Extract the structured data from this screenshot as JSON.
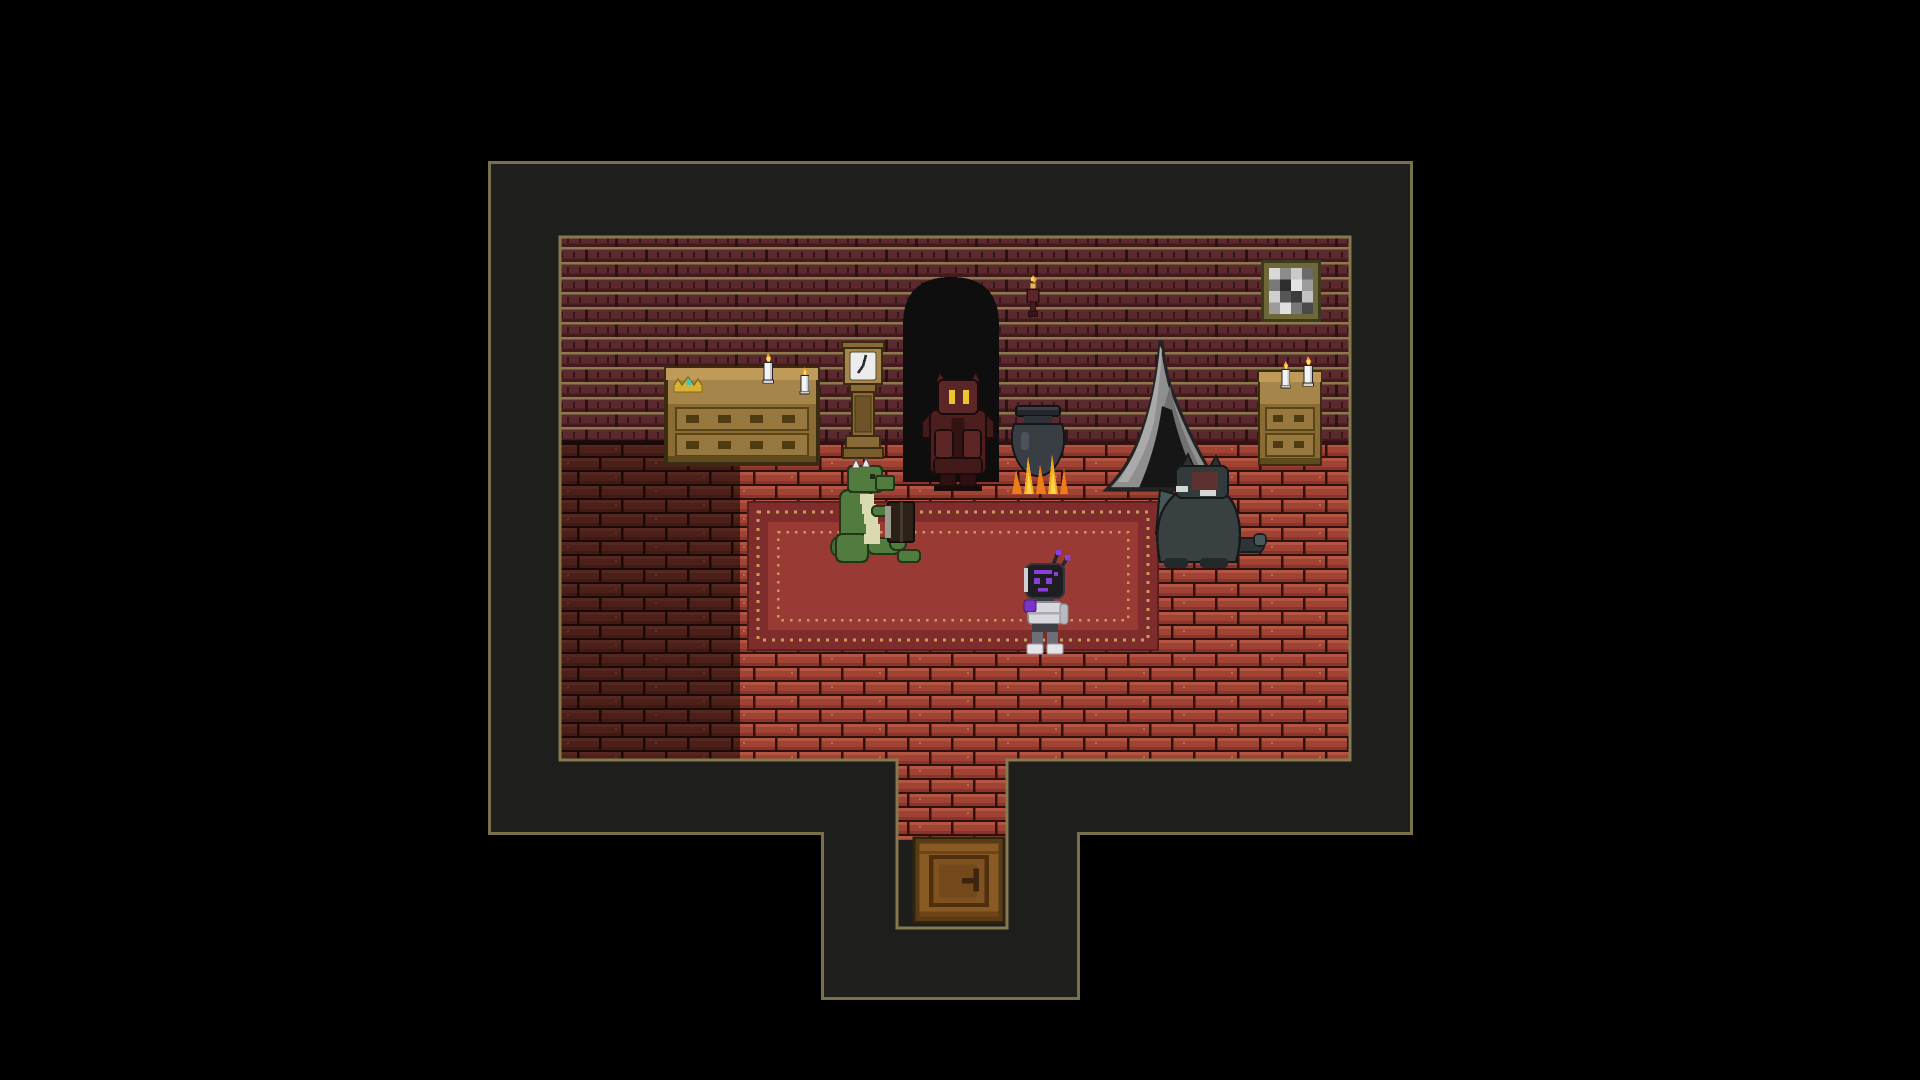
{
  "meta": {
    "type": "game-scene",
    "style": "pixel-art RPG interior, dark brick room viewed top-down"
  },
  "palette": {
    "background": "#000000",
    "void": "#1e1e1c",
    "outline_tan": "#79704a",
    "wall_brick": "#5b2a2e",
    "wall_mortar": "#8a7a4e",
    "floor_brick": "#a04334",
    "carpet_field": "#993a35",
    "carpet_band": "#7e2d2c",
    "carpet_dots": "#c99f58",
    "wood": "#8a6b38",
    "flame_orange": "#f6a81f",
    "eye_yellow": "#ecc62a",
    "robot_purple": "#8a3fd8",
    "lizard_green": "#527c3d"
  },
  "scene": {
    "room_label": "brick-walled room with corridor leading to a door",
    "entities": {
      "building": {
        "label": "dark building footprint with tan outline"
      },
      "room_floor": {
        "label": "red brick room with shadowed left side"
      },
      "left_dresser": {
        "label": "wooden dresser with gold crown and candles"
      },
      "crown": {
        "label": "gold crown with teal gem"
      },
      "candle_left_1": {
        "label": "lit white candle"
      },
      "candle_left_2": {
        "label": "lit white candle"
      },
      "grandfather_clock": {
        "label": "grandfather clock"
      },
      "alcove": {
        "label": "dark arched alcove"
      },
      "wall_sconce": {
        "label": "lit candle wall sconce"
      },
      "hooded_figure": {
        "label": "dark red hooded figure with yellow eyes"
      },
      "cauldron": {
        "label": "black cauldron over orange flames"
      },
      "tent": {
        "label": "grey tent with dark opening"
      },
      "cat_figure": {
        "label": "dark cat creature sitting by the tent"
      },
      "right_dresser": {
        "label": "small wooden dresser with two candles"
      },
      "candle_right_1": {
        "label": "lit white candle"
      },
      "candle_right_2": {
        "label": "lit white candle"
      },
      "framed_picture": {
        "label": "framed grey mosaic picture"
      },
      "carpet": {
        "label": "red carpet with dotted tan border"
      },
      "lizard_character": {
        "label": "green lizard sitting and reading a dark book"
      },
      "robot_character": {
        "label": "white and purple robot with antennae"
      },
      "door": {
        "label": "brown wooden door with handle"
      }
    }
  }
}
